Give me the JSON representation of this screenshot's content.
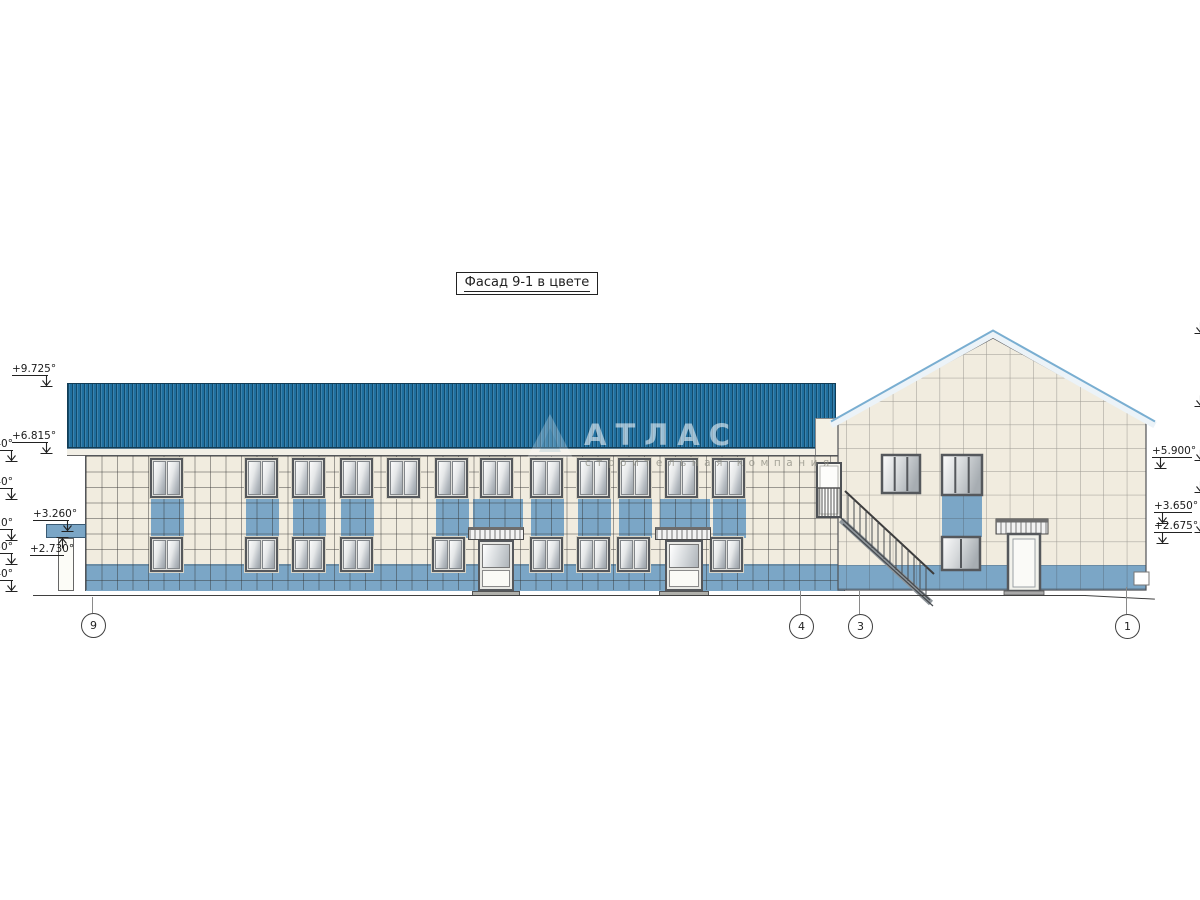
{
  "title_box": {
    "text": "Фасад 9-1 в цвете"
  },
  "watermark": {
    "logo": "triangle-icon",
    "title": "АТЛАС",
    "subtitle": "строительная компания"
  },
  "elevations": {
    "left": [
      {
        "id": "roof-ridge",
        "label": "+9.725°"
      },
      {
        "id": "eaves",
        "label": "+6.815°"
      },
      {
        "id": "porch-canopy-top",
        "label": "+3.260°"
      },
      {
        "id": "porch-canopy-bottom",
        "label": "+2.730°"
      }
    ],
    "left_partial": [
      {
        "label": "40°"
      },
      {
        "label": "40°"
      },
      {
        "label": "10°"
      },
      {
        "label": "50°"
      },
      {
        "label": "40°"
      }
    ],
    "right": [
      {
        "label": "+5.900°"
      },
      {
        "label": "+3.650°"
      },
      {
        "label": "+2.675°"
      }
    ]
  },
  "axis_markers": [
    {
      "label": "9"
    },
    {
      "label": "4"
    },
    {
      "label": "3"
    },
    {
      "label": "1"
    }
  ],
  "colors": {
    "roof_blue": "#1f6f9f",
    "wall_tile_cream": "#f1ecdf",
    "accent_tile_blue": "#7ba6c6",
    "drawing_line": "#3f3f3f"
  }
}
